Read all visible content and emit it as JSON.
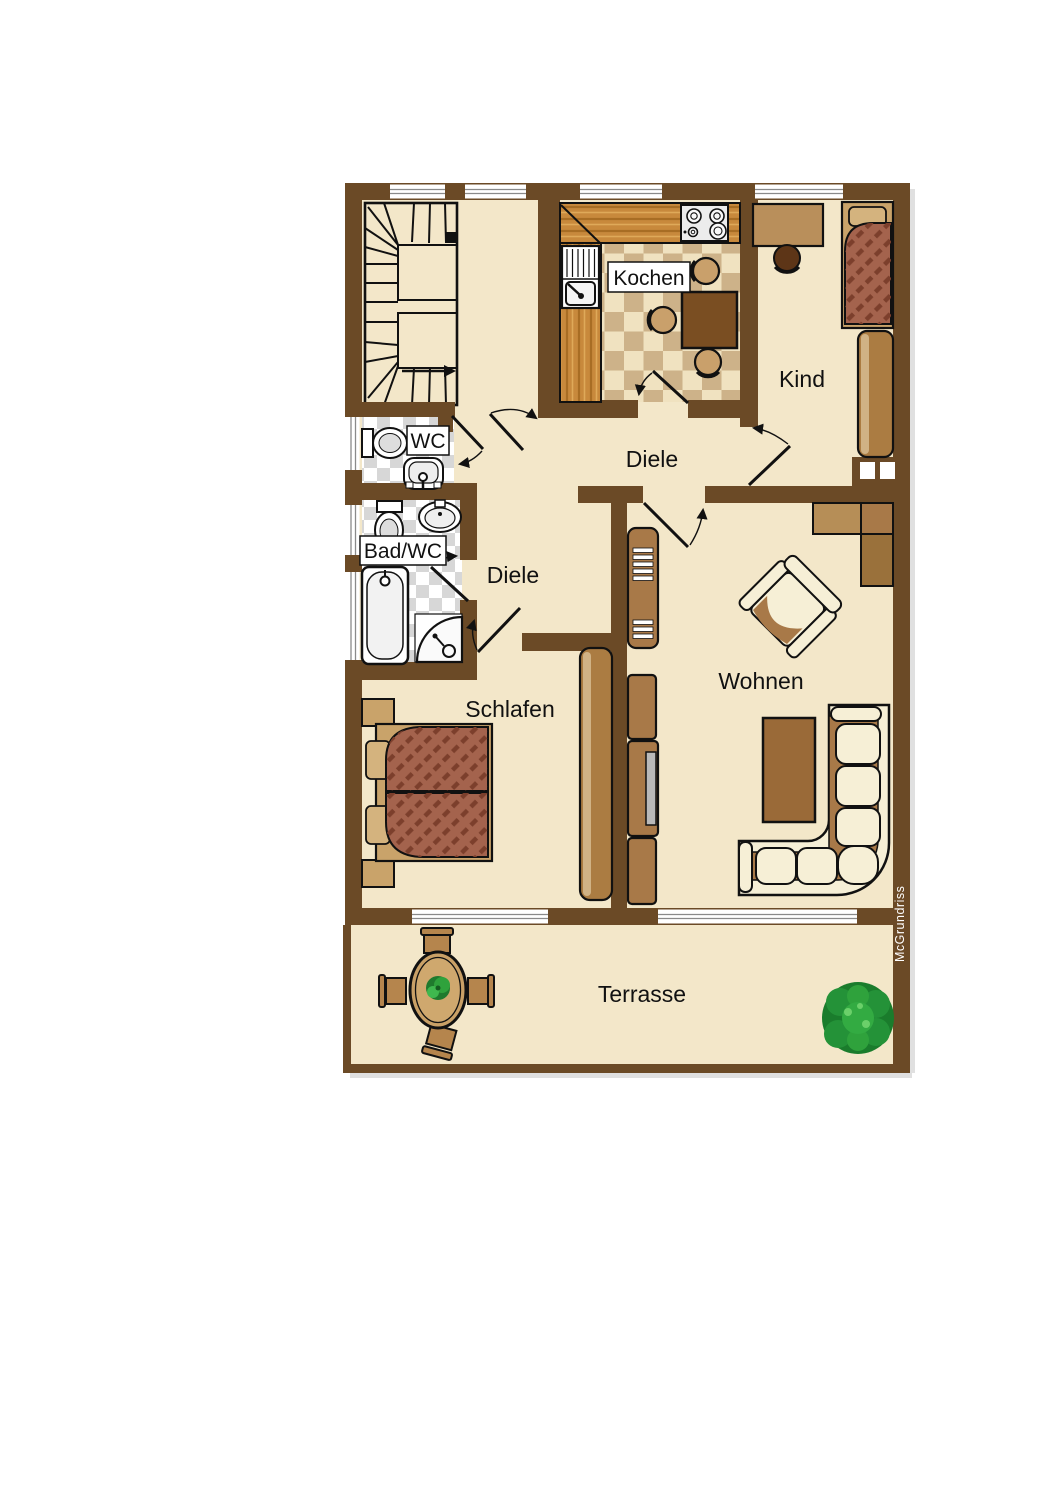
{
  "watermark": "McGrundriss",
  "rooms": {
    "kitchen": {
      "label": "Kochen"
    },
    "child": {
      "label": "Kind"
    },
    "hall_upper": {
      "label": "Diele"
    },
    "hall_lower": {
      "label": "Diele"
    },
    "wc": {
      "label": "WC"
    },
    "bath": {
      "label": "Bad/WC"
    },
    "bedroom": {
      "label": "Schlafen"
    },
    "living": {
      "label": "Wohnen"
    },
    "terrace": {
      "label": "Terrasse"
    }
  },
  "colors": {
    "wall": "#6b4a26",
    "floor": "#f3e7c9",
    "kitchen_tile_light": "#f0e2c0",
    "kitchen_tile_dark": "#cdb289",
    "bath_tile_light": "#ffffff",
    "bath_tile_dark": "#d7d7d7",
    "wood_counter": "#c8893c",
    "wood_grain": "#a86d24",
    "wood_light": "#dfa959",
    "furniture_light": "#c9a36a",
    "furniture_mid": "#a87948",
    "furniture_dark": "#5d3517",
    "table_dark": "#7a4e22",
    "bed_cover": "#a4634d",
    "bed_stripe": "#7c3f2c",
    "cushion_cream": "#f6efd6",
    "screen_gray": "#b9b9b9",
    "tree_green": "#1a7c2c",
    "window_line": "#8a8a8a",
    "outline": "#111111"
  }
}
